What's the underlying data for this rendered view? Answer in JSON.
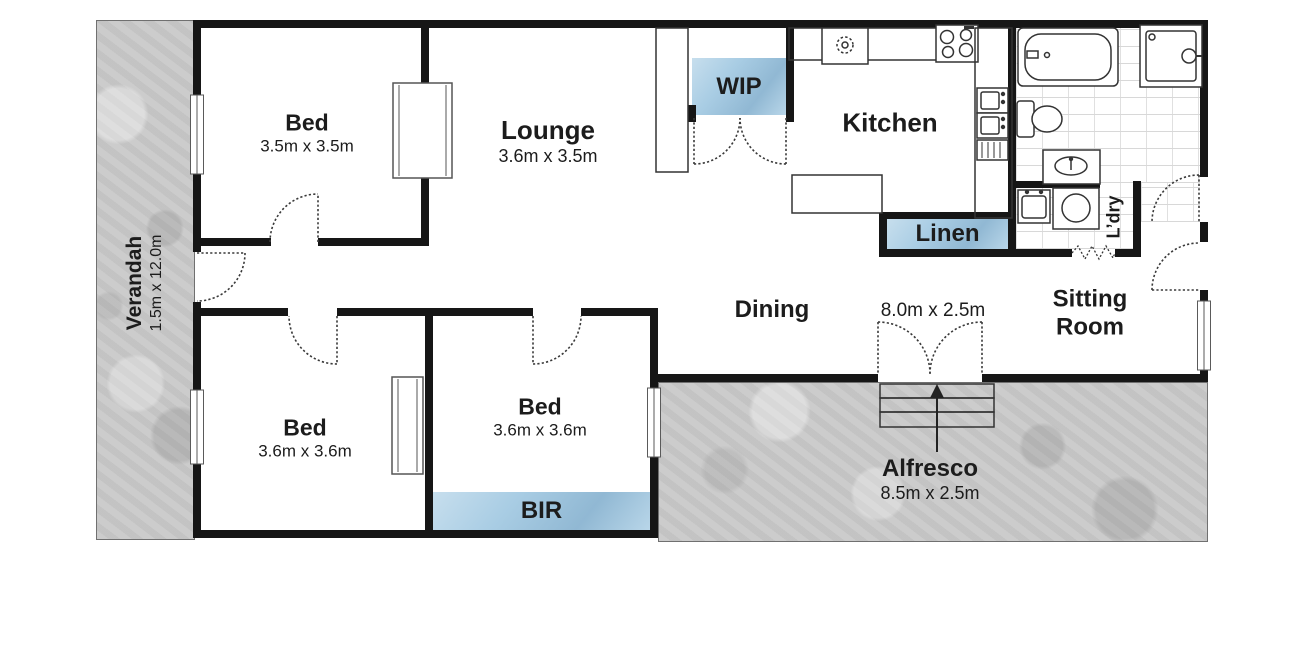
{
  "title": "Floor plan",
  "colors": {
    "wall": "#161616",
    "closet_blue": "#a9cde4",
    "concrete_gray": "#c9c9c9",
    "text": "#1c1c1c"
  },
  "rooms": {
    "verandah": {
      "name": "Verandah",
      "dims": "1.5m x 12.0m"
    },
    "bed1": {
      "name": "Bed",
      "dims": "3.5m x 3.5m"
    },
    "lounge": {
      "name": "Lounge",
      "dims": "3.6m x 3.5m"
    },
    "kitchen": {
      "name": "Kitchen"
    },
    "wip": {
      "name": "WIP"
    },
    "linen": {
      "name": "Linen"
    },
    "laundry": {
      "name": "L’dry"
    },
    "sitting": {
      "line1": "Sitting",
      "line2": "Room"
    },
    "dining": {
      "name": "Dining",
      "dims": "8.0m x 2.5m"
    },
    "bed2": {
      "name": "Bed",
      "dims": "3.6m x 3.6m"
    },
    "bed3": {
      "name": "Bed",
      "dims": "3.6m x 3.6m"
    },
    "bir": {
      "name": "BIR"
    },
    "alfresco": {
      "name": "Alfresco",
      "dims": "8.5m x 2.5m"
    }
  }
}
